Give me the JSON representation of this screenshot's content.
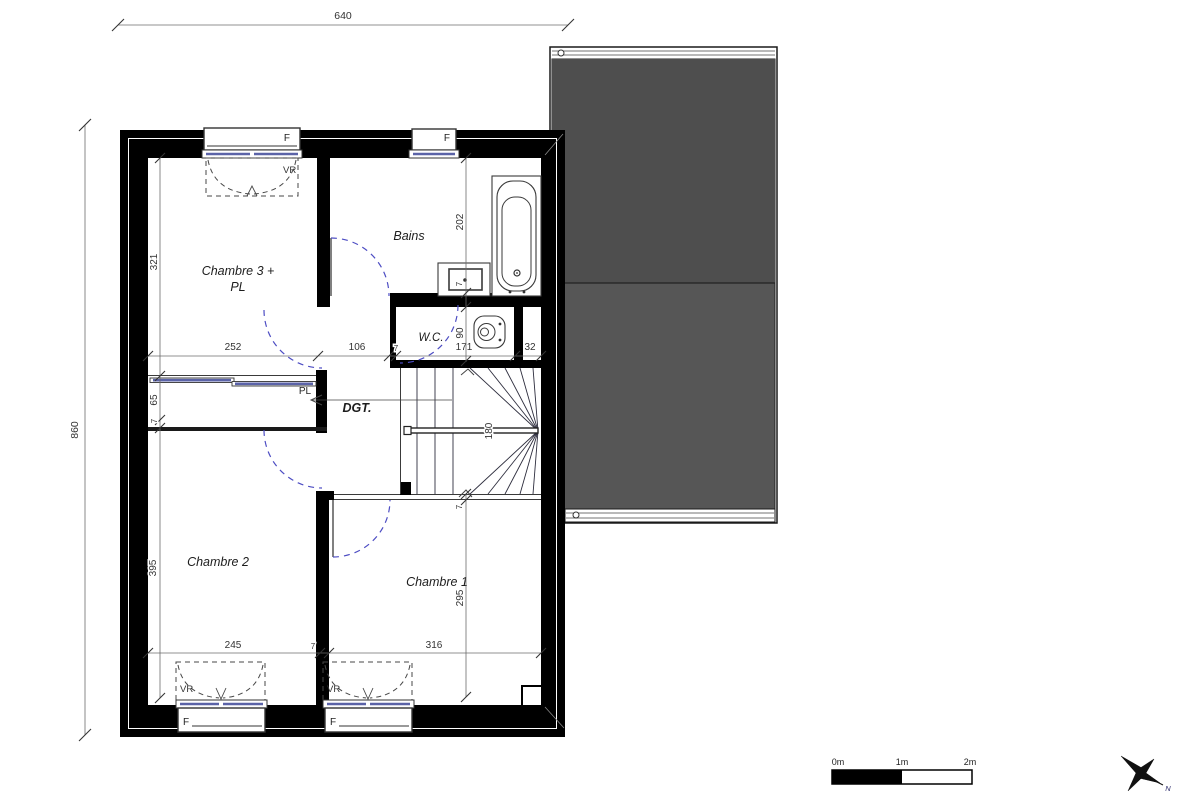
{
  "plan": {
    "overall_dims": {
      "width": "640",
      "height": "860"
    },
    "rooms": {
      "chambre3_line1": "Chambre 3 +",
      "chambre3_line2": "PL",
      "bains": "Bains",
      "wc": "W.C.",
      "dgt": "DGT.",
      "closet": "PL",
      "chambre2": "Chambre 2",
      "chambre1": "Chambre 1"
    },
    "dims": {
      "d640": "640",
      "d860": "860",
      "d321": "321",
      "d252": "252",
      "d106": "106",
      "seven": "7",
      "d171": "171",
      "d32": "32",
      "d202": "202",
      "d90": "90",
      "d180": "180",
      "d65": "65",
      "d395": "395",
      "d245": "245",
      "d316": "316",
      "d295": "295"
    },
    "windows": {
      "window_label": "F",
      "shutter_label": "VR"
    },
    "colors": {
      "wall": "#000000",
      "roof": "#565656",
      "roof_upper": "#4e4e4e",
      "glazing_blue": "#5b63a8",
      "door_arc_blue": "#4d4dc3"
    }
  },
  "scale_bar": {
    "zero": "0m",
    "one": "1m",
    "two": "2m"
  },
  "compass": {
    "north": "N"
  }
}
